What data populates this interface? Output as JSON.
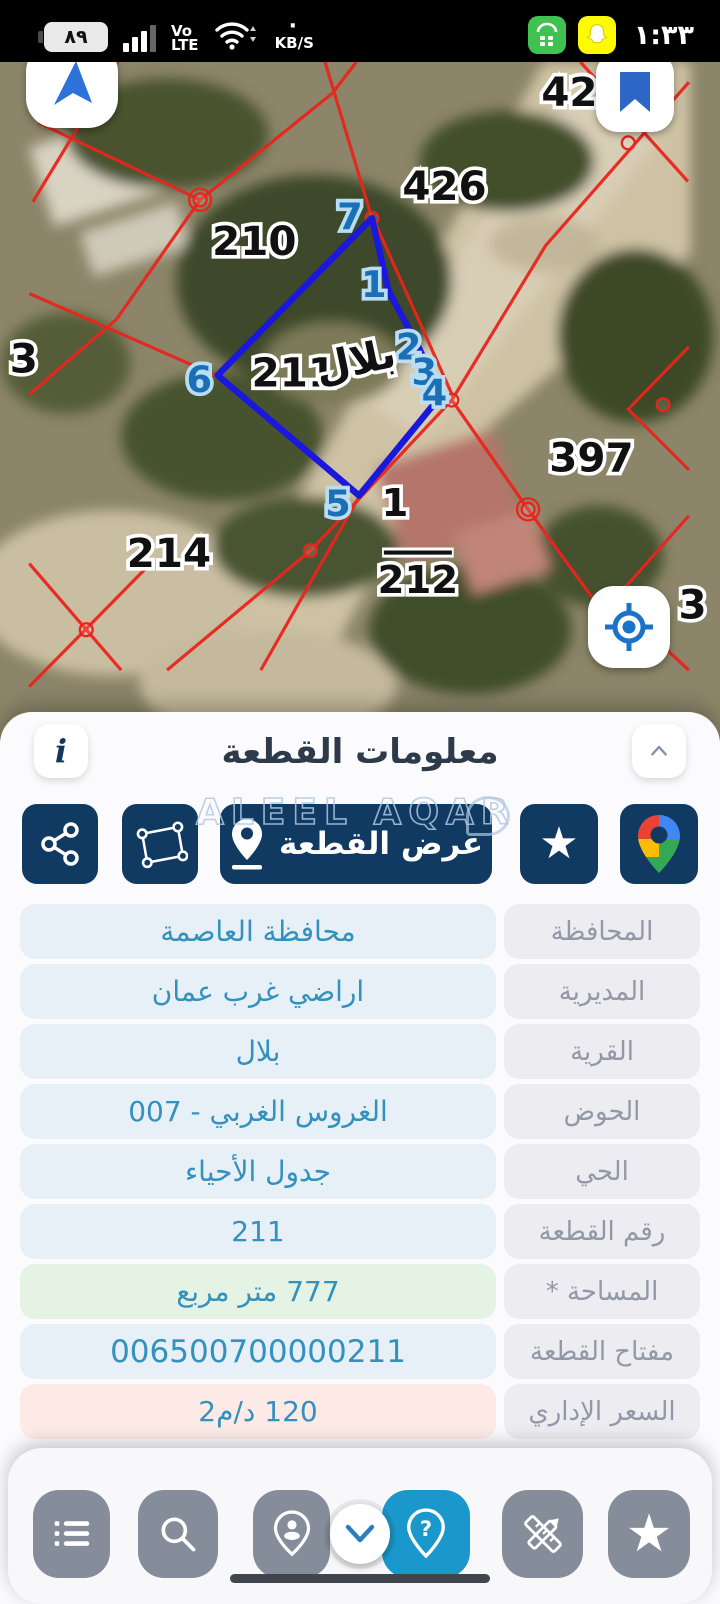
{
  "status_bar": {
    "battery": "٨٩",
    "network_line1": "Vo",
    "network_line2": "LTE",
    "speed_unit": "KB/S",
    "time": "١:٣٣",
    "icons": [
      "battery",
      "signal-bars",
      "wifi",
      "green-app",
      "snapchat"
    ]
  },
  "map": {
    "village_label": "بلال",
    "labels": {
      "p426": "426",
      "p210": "210",
      "p211": "211",
      "p397": "397",
      "p214": "214",
      "p1": "1",
      "p212": "212",
      "p42": "42",
      "p3_left": "3",
      "p3_right": "3"
    },
    "vertices": [
      "7",
      "1",
      "2",
      "3",
      "4",
      "5",
      "6"
    ],
    "controls": [
      "compass",
      "bookmark",
      "my-location"
    ]
  },
  "panel": {
    "title": "معلومات القطعة",
    "info_button": "i",
    "watermark": "ALEEL AQAR",
    "view_parcel_label": "عرض القطعة",
    "rows": [
      {
        "label": "المحافظة",
        "value": "محافظة العاصمة"
      },
      {
        "label": "المديرية",
        "value": "اراضي غرب عمان"
      },
      {
        "label": "القرية",
        "value": "بلال"
      },
      {
        "label": "الحوض",
        "value": "الغروس الغربي - 007"
      },
      {
        "label": "الحي",
        "value": "جدول الأحياء"
      },
      {
        "label": "رقم القطعة",
        "value": "211"
      },
      {
        "label": "المساحة *",
        "value": "777 متر مربع"
      },
      {
        "label": "مفتاح القطعة",
        "value": "006500700000211"
      },
      {
        "label": "السعر الإداري",
        "value": "120 د/م2"
      }
    ]
  },
  "colors": {
    "navy_button": "#103a61",
    "active_nav": "#1b98cb",
    "nav_gray": "#858d9b",
    "value_text": "#3391bd",
    "label_text": "#9298a6",
    "value_bg": "#e7eff7",
    "label_bg": "#ececf1",
    "area_bg": "#e4f3e4",
    "price_bg": "#fdeae7",
    "parcel_line_red": "#e8251d",
    "selection_blue": "#1a18dc"
  }
}
